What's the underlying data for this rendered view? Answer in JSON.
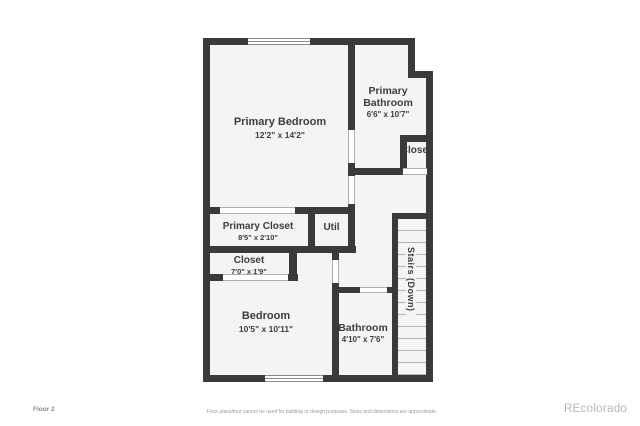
{
  "rooms": {
    "primary_bedroom": {
      "name": "Primary Bedroom",
      "dims": "12'2\" x 14'2\""
    },
    "primary_bathroom": {
      "name": "Primary Bathroom",
      "dims": "6'6\" x 10'7\""
    },
    "closet_upper": {
      "name": "Closet"
    },
    "primary_closet": {
      "name": "Primary Closet",
      "dims": "8'5\" x 2'10\""
    },
    "util": {
      "name": "Util"
    },
    "closet_lower": {
      "name": "Closet",
      "dims": "7'0\" x 1'9\""
    },
    "bedroom": {
      "name": "Bedroom",
      "dims": "10'5\" x 10'11\""
    },
    "bathroom": {
      "name": "Bathroom",
      "dims": "4'10\" x 7'6\""
    },
    "stairs": {
      "name": "Stairs (Down)"
    }
  },
  "footer": {
    "floor_label": "Floor 2",
    "disclaimer": "Floor plans/tour cannot be used for building or design purposes. Sizes and dimensions are approximate.",
    "watermark": "REcolorado"
  },
  "colors": {
    "wall": "#3a3a3a",
    "floor": "#f4f4f4",
    "label": "#3d3d3d",
    "watermark": "#b5b5b5"
  }
}
